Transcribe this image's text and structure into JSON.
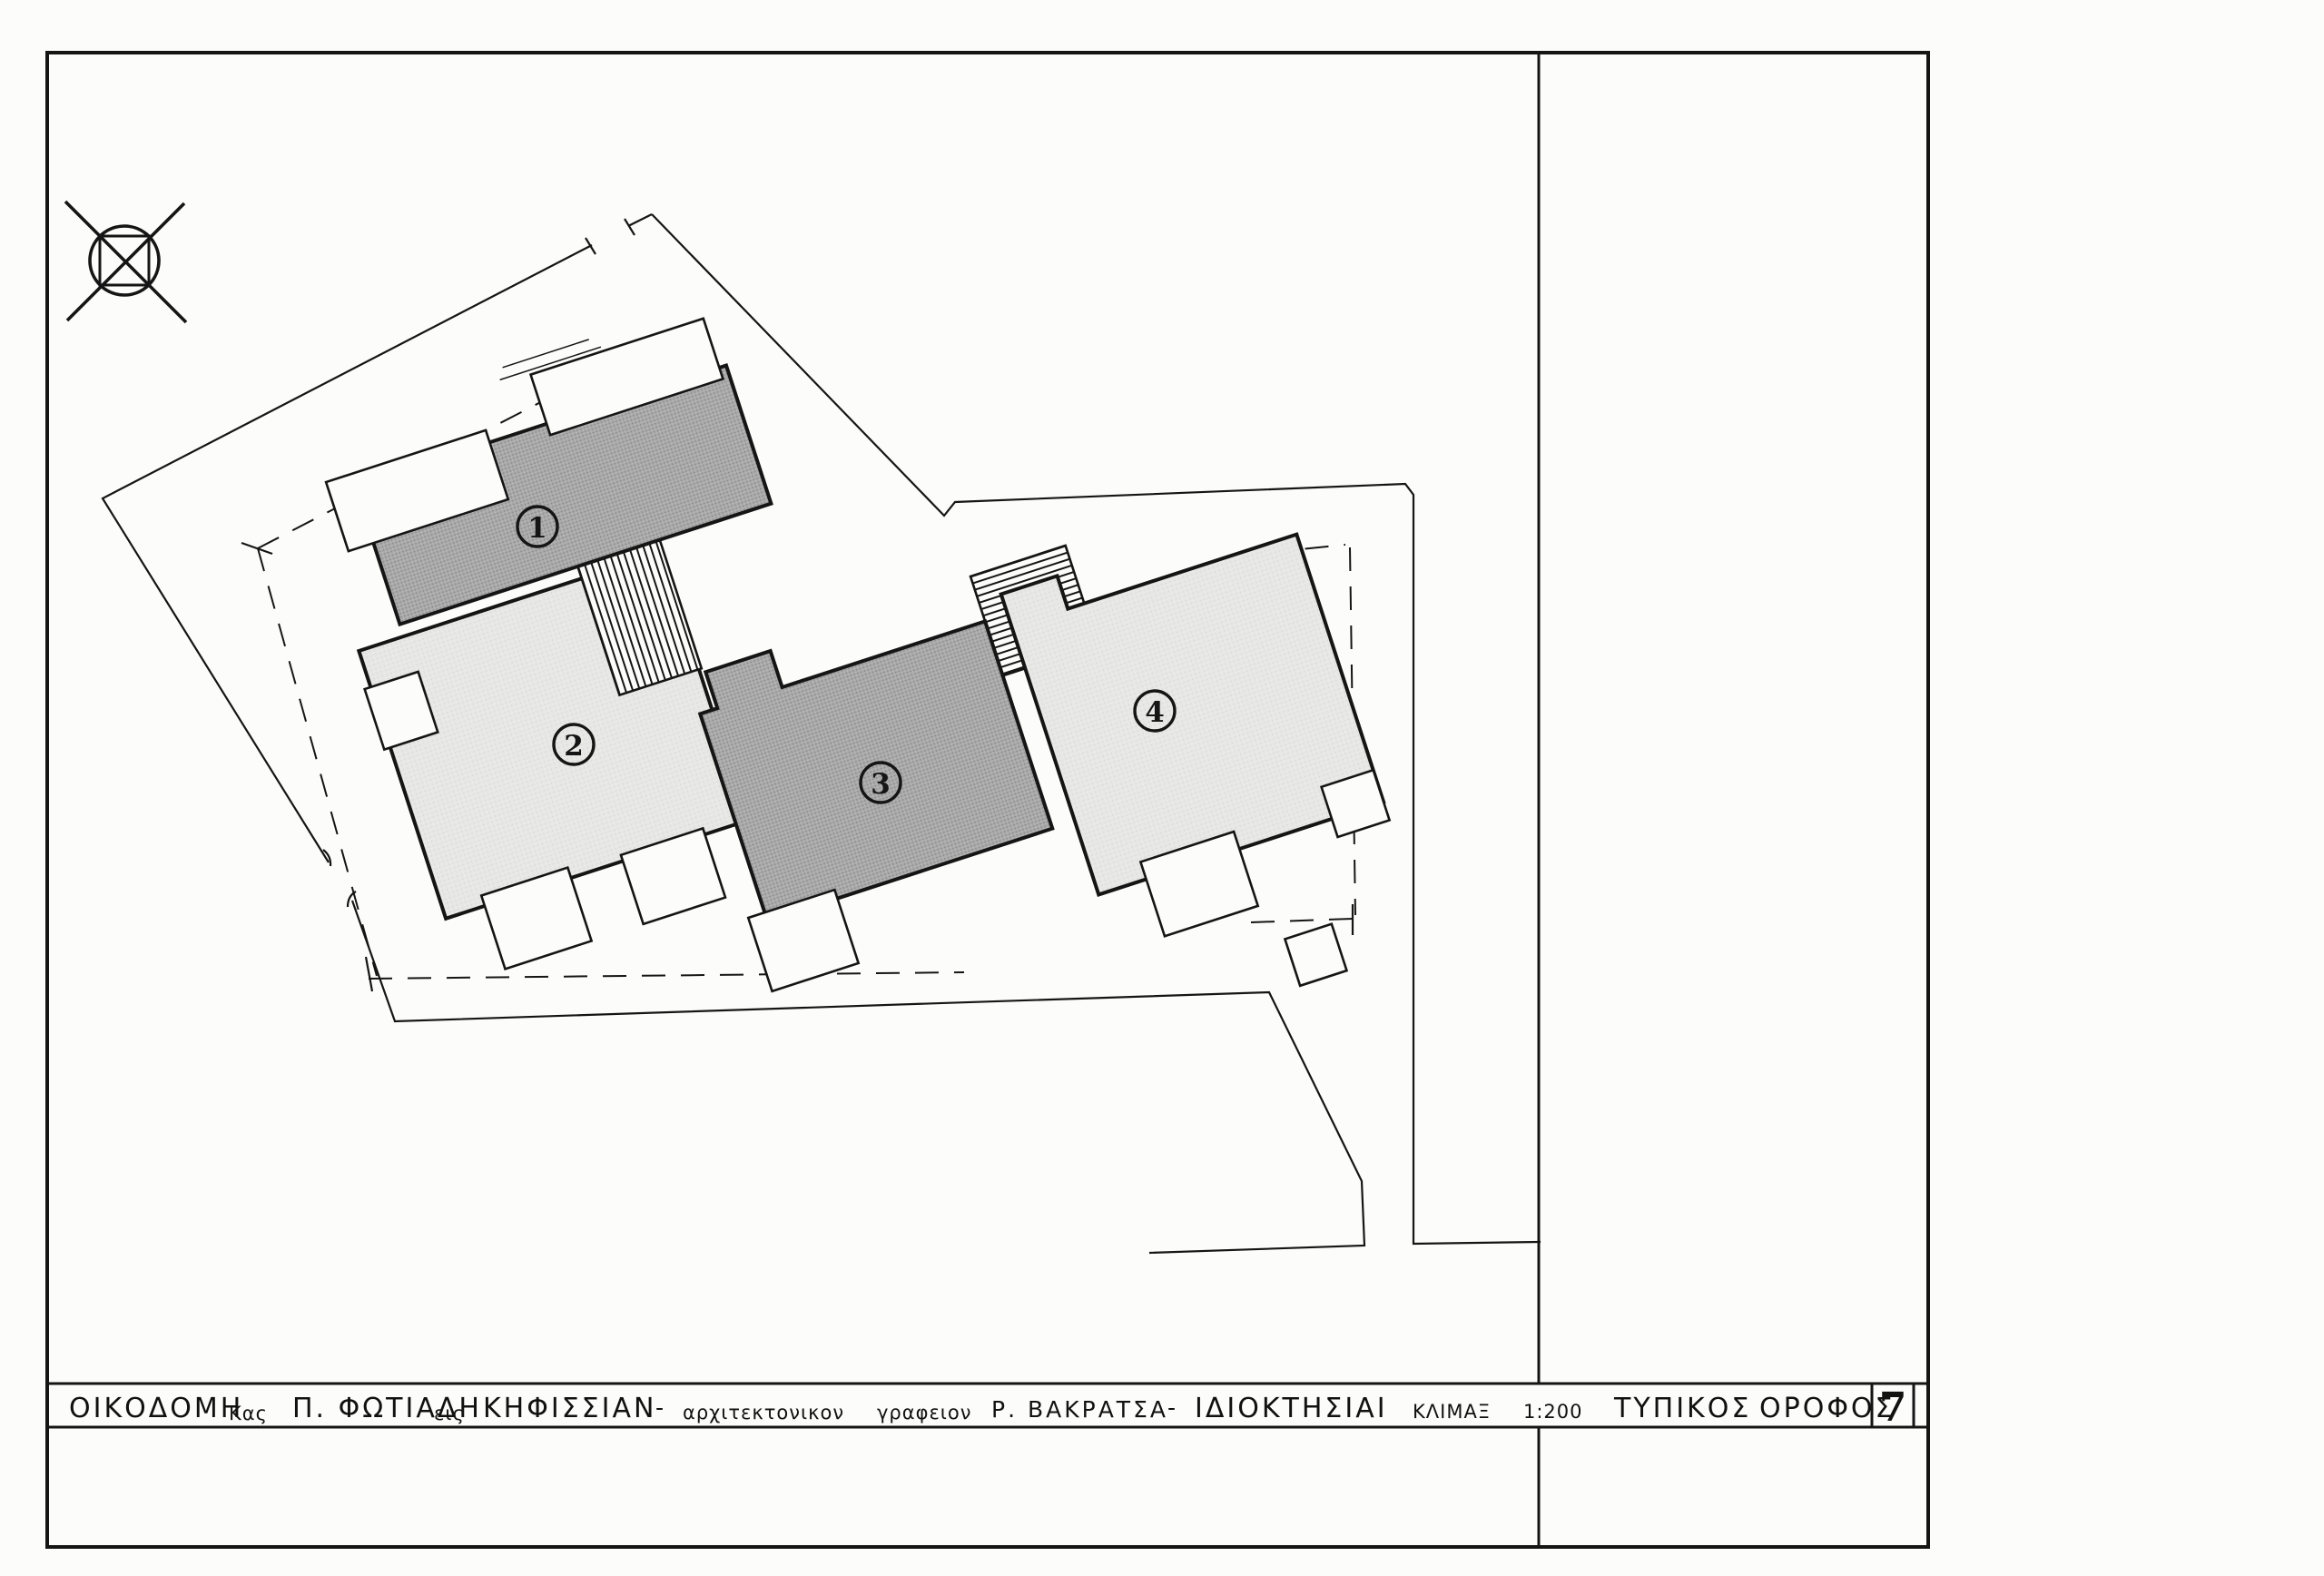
{
  "drawing": {
    "type": "architectural-site-plan",
    "building_labels": [
      "1",
      "2",
      "3",
      "4"
    ],
    "colors": {
      "line": "#151515",
      "dark_building_fill": "#a9a9a9",
      "light_building_fill": "#e7e7e5",
      "paper": "#fcfcfa"
    }
  },
  "title_block": {
    "project_label": "ΟΙΚΟΔΟΜΗ",
    "owner_prefix": "Κας",
    "owner_name": "Π. ΦΩΤΙΑΔΗ",
    "location_prefix": "εις",
    "location": "ΚΗΦΙΣΣΙΑΝ",
    "dash1": "-",
    "office_word1": "αρχιτεκτονικον",
    "office_word2": "γραφειον",
    "architect": "Ρ. ΒΑΚΡΑΤΣΑ",
    "dash2": "-",
    "subject": "ΙΔΙΟΚΤΗΣΙΑΙ",
    "scale_label": "ΚΛΙΜΑΞ",
    "scale_value": "1:200",
    "plan_type_word1": "ΤΥΠΙΚΟΣ",
    "plan_type_word2": "ΟΡΟΦΟΣ",
    "sheet_number": "7"
  }
}
